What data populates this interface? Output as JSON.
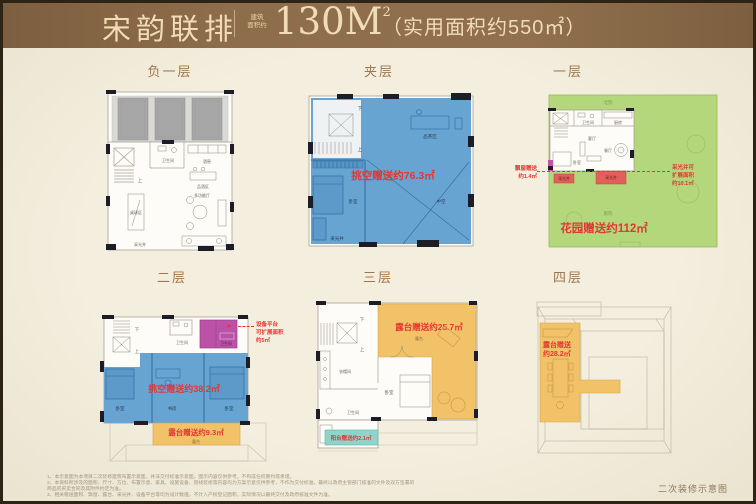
{
  "header": {
    "project": "宋韵联排",
    "seal_line1": "建筑",
    "seal_line2": "面积约",
    "area_value": "130M",
    "area_sup": "2",
    "usable": "（实用面积约550㎡）"
  },
  "floors": {
    "b1": {
      "title": "负一层",
      "rooms": {
        "bath": "卫生间",
        "cellar": "酒窖",
        "tasting": "品酒区",
        "billiards": "桌球区",
        "hall": "多功能厅",
        "well": "采光井",
        "up": "上"
      }
    },
    "jc": {
      "title": "夹层",
      "gift": "挑空赠送约76.3㎡",
      "rooms": {
        "down": "下",
        "up": "上",
        "tea": "品茶区",
        "bed": "卧室",
        "void": "中空",
        "well": "采光井"
      }
    },
    "f1": {
      "title": "一层",
      "gift": "花园赠送约112㎡",
      "rooms": {
        "north_yard": "北院",
        "south_yard": "南院",
        "bath": "卫生间",
        "kitchen": "厨房",
        "living": "客厅",
        "dining": "餐厅",
        "bed": "卧室",
        "well1": "采光井",
        "well2": "采光井"
      },
      "bay_note": [
        "飘窗赠送",
        "约1.4㎡"
      ],
      "well_note": [
        "采光井可",
        "扩展面积",
        "约10.1㎡"
      ]
    },
    "f2": {
      "title": "二层",
      "gift_void": "挑空赠送约38.2㎡",
      "gift_terrace": "露台赠送约9.3㎡",
      "rooms": {
        "down": "下",
        "up": "上",
        "bath1": "卫生间",
        "bath2": "卫生间",
        "bed1": "卧室",
        "study": "书房",
        "bed2": "卧室",
        "terrace": "露台"
      },
      "equip_note": [
        "设备平台",
        "可扩展面积",
        "约5㎡"
      ]
    },
    "f3": {
      "title": "三层",
      "gift_terrace": "露台赠送约25.7㎡",
      "gift_balcony": "阳台赠送约2.1㎡",
      "rooms": {
        "down": "下",
        "up": "上",
        "cloak": "衣帽间",
        "bed": "卧室",
        "bath": "卫生间",
        "terrace": "露台"
      }
    },
    "f4": {
      "title": "四层",
      "gift_line1": "露台赠送",
      "gift_line2": "约28.2㎡"
    }
  },
  "footer": {
    "caption": "二次装修示意图",
    "disclaimers": [
      "1、本示意图为本项目二次装修建筑布置示意图，并非交付标准示意图，图示内容仅供参考，不构成任何要约或承诺。",
      "2、本资料所涉及的面积、尺寸、方位、布置示意、家具、设施设备、管线装修等内容均为方案示意仅供参考，不作为交付标准，最终以政府主管部门核准的文件及双方签署的商品房买卖合同及其附件约定为准。",
      "3、相关赠送面积、飘窗、露台、采光井、设备平台等均为设计数值，不计入产权登记面积，实际情况以最终交付及政府核准文件为准。"
    ]
  }
}
